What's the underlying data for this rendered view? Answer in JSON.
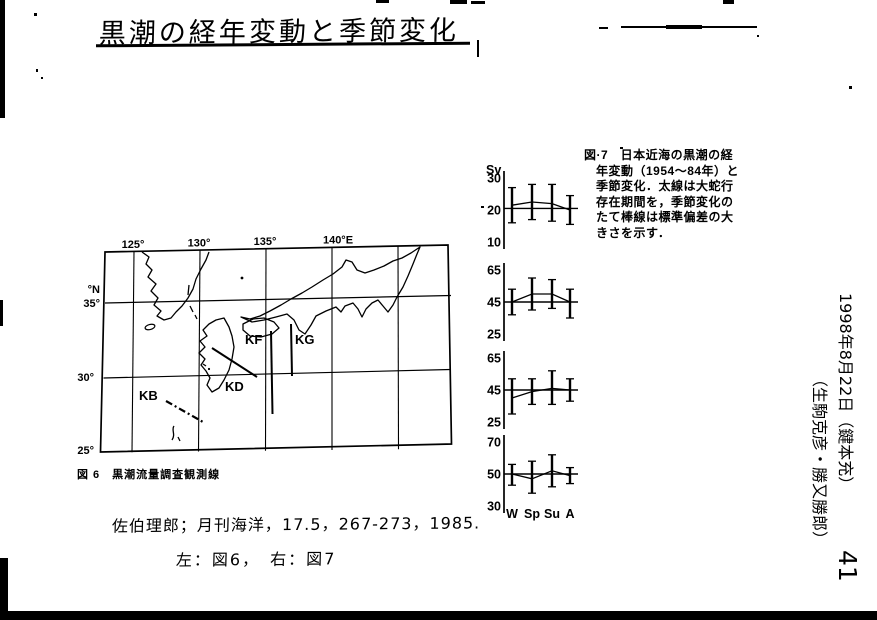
{
  "page": {
    "title": "黒潮の経年変動と季節変化",
    "page_number": "41"
  },
  "fig6": {
    "caption": "図 6　黒潮流量調査観測線",
    "lon_labels": [
      "125°",
      "130°",
      "135°",
      "140°E"
    ],
    "lat_unit": "°N",
    "lat_labels": [
      "35°",
      "30°",
      "25°"
    ],
    "survey_lines": [
      "KB",
      "KD",
      "KF",
      "KG"
    ]
  },
  "fig7": {
    "caption_lines": [
      "図·7　日本近海の黒潮の経",
      "年変動（1954～84年）と",
      "季節変化．太線は大蛇行",
      "存在期間を，季節変化の",
      "たて棒線は標準偏差の大",
      "きさを示す．"
    ]
  },
  "chart_data": [
    {
      "type": "line",
      "unit": "Sv",
      "yticks": [
        30,
        20,
        10
      ],
      "ylim": [
        8,
        32
      ],
      "mean_line": 20.5,
      "x": [
        "W",
        "Sp",
        "Su",
        "A"
      ],
      "values": [
        21.5,
        22.5,
        22,
        20
      ],
      "err_lo": [
        16,
        17,
        16.5,
        15.5
      ],
      "err_hi": [
        27,
        28,
        28,
        24.5
      ],
      "show_x_labels": false
    },
    {
      "type": "line",
      "yticks": [
        65,
        45,
        25
      ],
      "ylim": [
        23,
        67
      ],
      "mean_line": 45,
      "x": [
        "W",
        "Sp",
        "Su",
        "A"
      ],
      "values": [
        45,
        50,
        50,
        45
      ],
      "err_lo": [
        37,
        40,
        41,
        35
      ],
      "err_hi": [
        53,
        60,
        59,
        53
      ],
      "show_x_labels": false
    },
    {
      "type": "line",
      "yticks": [
        65,
        45,
        25
      ],
      "ylim": [
        23,
        67
      ],
      "mean_line": 45,
      "x": [
        "W",
        "Sp",
        "Su",
        "A"
      ],
      "values": [
        40,
        44,
        46,
        45
      ],
      "err_lo": [
        30,
        36,
        36,
        38
      ],
      "err_hi": [
        52,
        52,
        57,
        52
      ],
      "show_x_labels": false
    },
    {
      "type": "line",
      "yticks": [
        70,
        50,
        30
      ],
      "ylim": [
        28,
        72
      ],
      "mean_line": 50,
      "x": [
        "W",
        "Sp",
        "Su",
        "A"
      ],
      "values": [
        50,
        47,
        52,
        49
      ],
      "err_lo": [
        43,
        38,
        42,
        44
      ],
      "err_hi": [
        56,
        58,
        62,
        54
      ],
      "show_x_labels": true
    }
  ],
  "margin_notes": {
    "citation": "佐伯理郎；月刊海洋，17.5，267-273，1985.",
    "figure_note": "左：図6，　右：図7",
    "date_note": "1998年8月22日（鍵本充）",
    "names_note": "（生駒克彦・勝又勝郎）"
  }
}
